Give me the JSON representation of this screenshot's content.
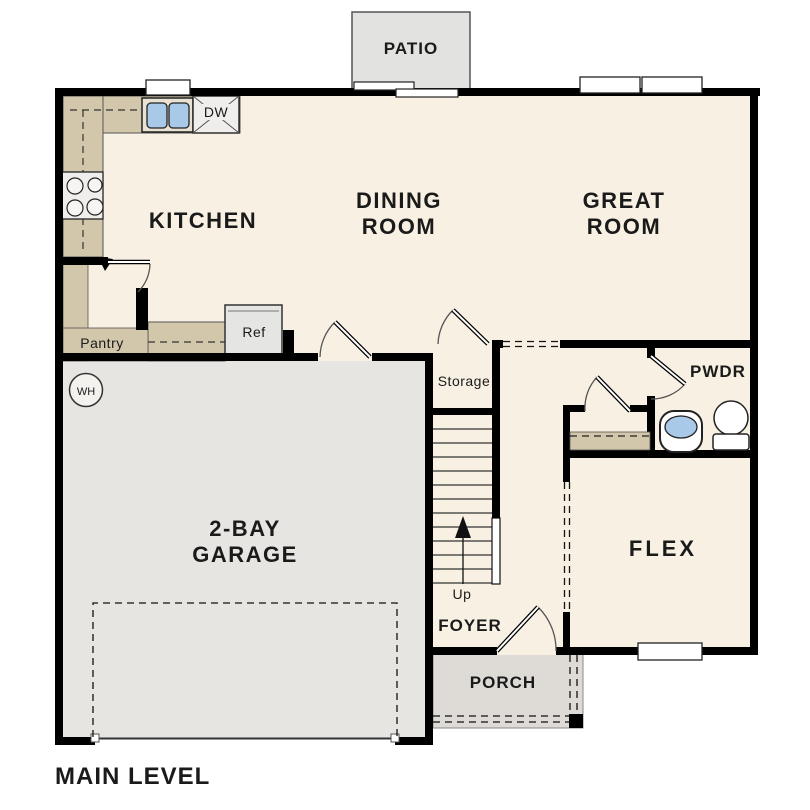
{
  "plan": {
    "title": "MAIN LEVEL",
    "labels": {
      "patio": "PATIO",
      "kitchen": "KITCHEN",
      "dining1": "DINING",
      "dining2": "ROOM",
      "great1": "GREAT",
      "great2": "ROOM",
      "garage1": "2-BAY",
      "garage2": "GARAGE",
      "flex": "FLEX",
      "pwdr": "PWDR",
      "foyer": "FOYER",
      "porch": "PORCH",
      "storage": "Storage",
      "pantry": "Pantry",
      "ref": "Ref",
      "dw": "DW",
      "up": "Up",
      "wh": "WH"
    },
    "colors": {
      "floor": "#f8f1e3",
      "counter": "#d2c6ab",
      "garage_floor": "#e7e5e2",
      "patio": "#e2e2e0",
      "porch": "#dedbd7",
      "appliance": "#efeeec",
      "refrigerator": "#e5e5e3",
      "sink_blue": "#a9c9e9",
      "wall": "#000000"
    }
  }
}
